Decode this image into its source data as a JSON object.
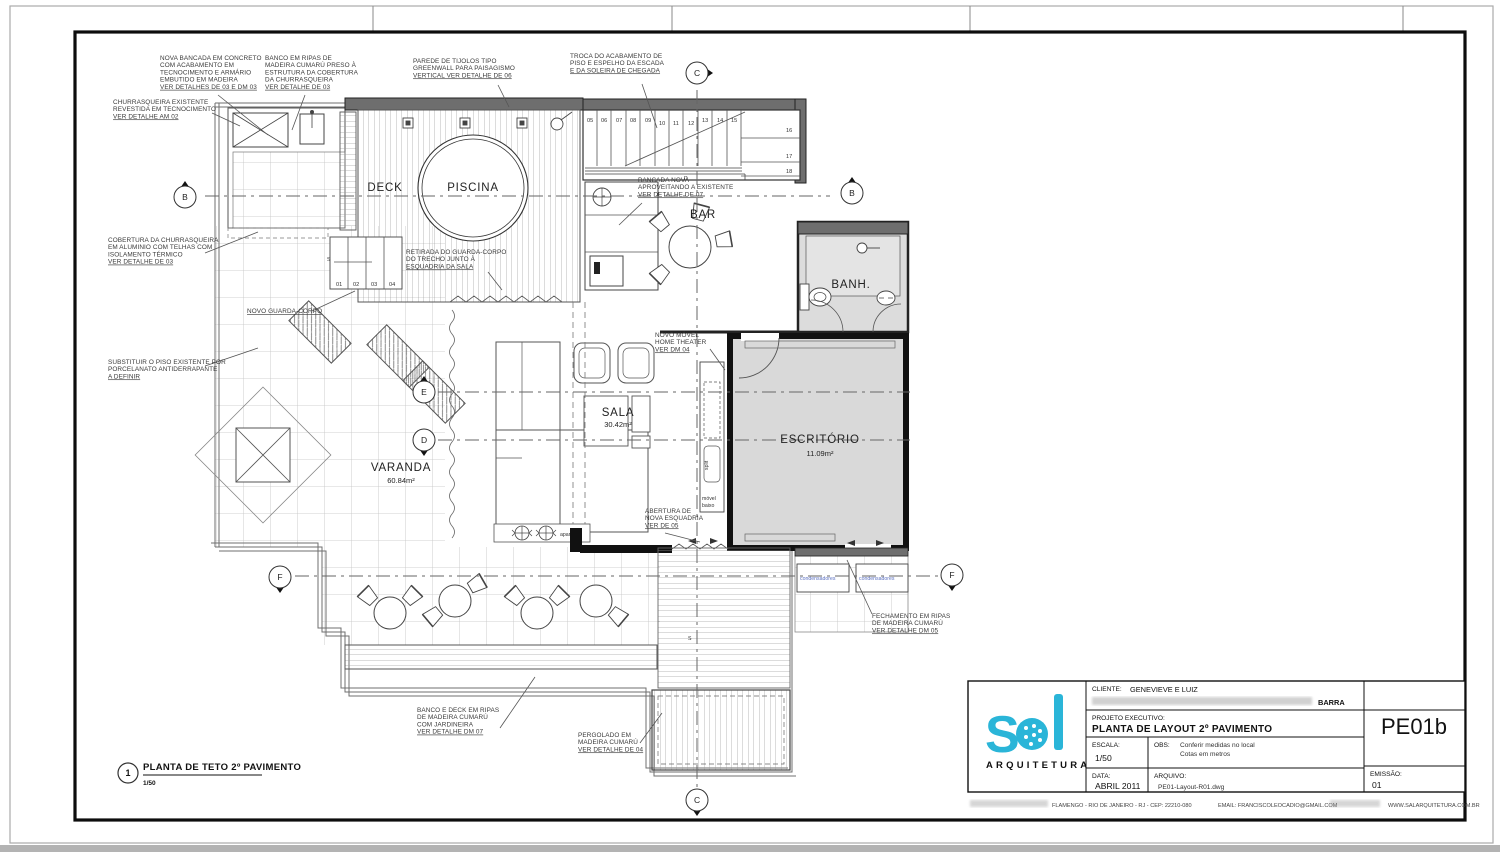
{
  "sheet": {
    "drawing_title": {
      "number": "1",
      "title": "PLANTA DE TETO 2º PAVIMENTO",
      "scale": "1/50"
    },
    "rooms": {
      "deck": "DECK",
      "piscina": "PISCINA",
      "bar": "BAR",
      "banh": "BANH.",
      "sala": {
        "name": "SALA",
        "area": "30.42m²"
      },
      "varanda": {
        "name": "VARANDA",
        "area": "60.84m²"
      },
      "escritorio": {
        "name": "ESCRITÓRIO",
        "area": "11.09m²"
      }
    },
    "small_labels": {
      "aparador": "aparador",
      "movel_1": "móvel",
      "movel_2": "baixo",
      "split": "split",
      "condensadores_1": "condensadores",
      "condensadores_2": "condensadores",
      "stair_up_1": "S",
      "stair_up_2": "S",
      "stair_d": "D"
    },
    "stairs": {
      "upper": [
        "05",
        "06",
        "07",
        "08",
        "09",
        "10",
        "11",
        "12",
        "13",
        "14",
        "15"
      ],
      "upper_right": [
        "16",
        "17",
        "18"
      ],
      "lower": [
        "01",
        "02",
        "03",
        "04"
      ]
    },
    "markers": {
      "b_left": "B",
      "b_right": "B",
      "c_top": "C",
      "c_bottom": "C",
      "d": "D",
      "e": "E",
      "f_left": "F",
      "f_right": "F"
    },
    "annotations": [
      {
        "lines": [
          "NOVA BANCADA EM CONCRETO",
          "COM ACABAMENTO EM",
          "TECNOCIMENTO E ARMÁRIO",
          "EMBUTIDO EM MADEIRA",
          "VER DETALHES DE 03 E DM 03"
        ]
      },
      {
        "lines": [
          "BANCO EM RIPAS DE",
          "MADEIRA CUMARÚ PRESO À",
          "ESTRUTURA DA COBERTURA",
          "DA CHURRASQUEIRA",
          "VER DETALHE DE 03"
        ]
      },
      {
        "lines": [
          "PAREDE DE TIJOLOS TIPO",
          "GREENWALL PARA PAISAGISMO",
          "VERTICAL VER DETALHE DE 06"
        ]
      },
      {
        "lines": [
          "TROCA DO ACABAMENTO DE",
          "PISO E ESPELHO DA ESCADA",
          "E DA SOLEIRA DE CHEGADA"
        ]
      },
      {
        "lines": [
          "CHURRASQUEIRA EXISTENTE",
          "REVESTIDA EM TECNOCIMENTO",
          "VER DETALHE AM 02"
        ]
      },
      {
        "lines": [
          "COBERTURA DA CHURRASQUEIRA",
          "EM ALUMINIO COM TELHAS COM",
          "ISOLAMENTO TÉRMICO",
          "VER DETALHE DE 03"
        ]
      },
      {
        "lines": [
          "SUBSTITUIR O PISO EXISTENTE POR",
          "PORCELANATO ANTIDERRAPANTE",
          "A DEFINIR"
        ]
      },
      {
        "lines": [
          "NOVO GUARDA-CORPO"
        ]
      },
      {
        "lines": [
          "RETIRADA DO GUARDA-CORPO",
          "DO TRECHO JUNTO À",
          "ESQUADRIA DA SALA"
        ]
      },
      {
        "lines": [
          "BANCADA NOVA",
          "APROVEITANDO A EXISTENTE",
          "VER DETALHE DE 07"
        ]
      },
      {
        "lines": [
          "NOVO MÓVEL",
          "HOME THEATER",
          "VER DM 04"
        ]
      },
      {
        "lines": [
          "ABERTURA DE",
          "NOVA ESQUADRIA",
          "VER DE 05"
        ]
      },
      {
        "lines": [
          "FECHAMENTO EM RIPAS",
          "DE MADEIRA CUMARÚ",
          "VER DETALHE DM 05"
        ]
      },
      {
        "lines": [
          "BANCO E DECK EM RIPAS",
          "DE MADEIRA CUMARÚ",
          "COM JARDINEIRA",
          "VER DETALHE DM 07"
        ]
      },
      {
        "lines": [
          "PERGOLADO EM",
          "MADEIRA CUMARÚ",
          "VER DETALHE DE 04"
        ]
      }
    ],
    "title_block": {
      "client_label": "CLIENTE:",
      "client": "GENEVIEVE  E  LUIZ",
      "client_address_visible": "BARRA",
      "project_label": "PROJETO EXECUTIVO:",
      "project": "PLANTA DE LAYOUT 2º PAVIMENTO",
      "scale_label": "ESCALA:",
      "scale": "1/50",
      "obs_label": "OBS:",
      "obs_line1": "Conferir medidas no local",
      "obs_line2": "Cotas em metros",
      "date_label": "DATA:",
      "date": "ABRIL 2011",
      "file_label": "ARQUIVO:",
      "file": "PE01-Layout-R01.dwg",
      "sheet_code": "PE01b",
      "emission_label": "EMISSÃO:",
      "emission": "01",
      "address": "FLAMENGO - RIO DE JANEIRO - RJ - CEP: 22210-080",
      "email": "EMAIL: FRANCISCOLEOCADIO@GMAIL.COM",
      "website": "WWW.SALARQUITETURA.COM.BR",
      "logo_text": "S",
      "logo_sub": "ARQUITETURA",
      "accent_color": "#2ab5d8"
    }
  }
}
